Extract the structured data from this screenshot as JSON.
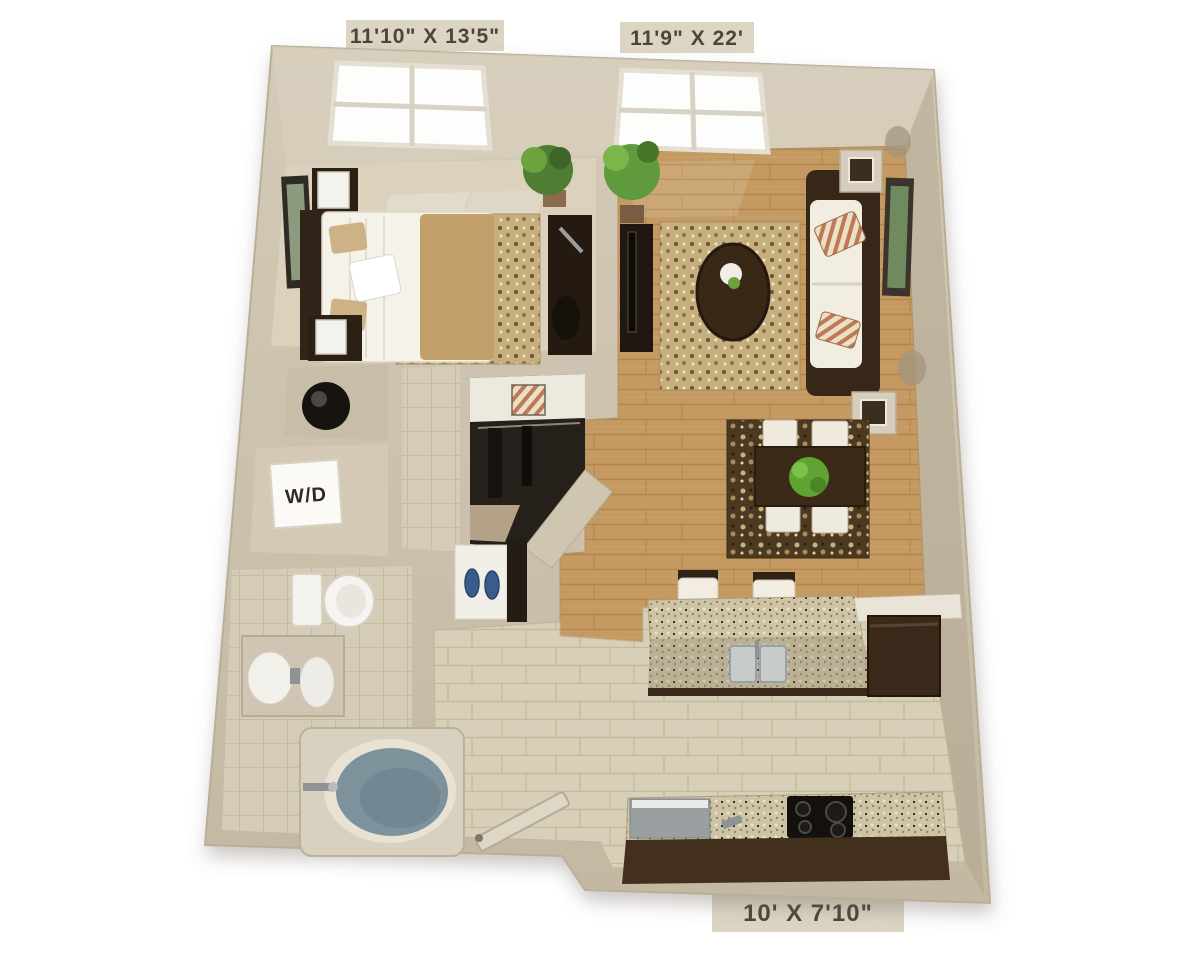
{
  "floor_plan": {
    "view": "3D top-down one-bedroom apartment floor plan",
    "labels": {
      "bedroom_dimensions": "11'10\" X 13'5\"",
      "living_room_dimensions": "11'9\" X 22'",
      "kitchen_dimensions": "10' X 7'10\"",
      "washer_dryer": "W/D"
    },
    "colors": {
      "background": "#ffffff",
      "wall": "#cac0ac",
      "wall_shadow": "#b0a48c",
      "label_tab": "#dcd5c4",
      "label_text": "#4b463b",
      "carpet": "#dbd1bd",
      "wood_floor": "#c49a62",
      "tile_floor": "#d8cfb8",
      "bath_tile": "#d5ccb7",
      "dark_wood": "#3a2a1b",
      "sofa_cushion": "#f2ede1",
      "rug_tan": "#c7ae7d",
      "rug_dark": "#4c3922",
      "granite": "#cfc3a5",
      "bath_water": "#7d929b",
      "plant_green": "#5f9a3e",
      "appliance_gray": "#9aa0a2",
      "closet_dark": "#26201a",
      "slipper_blue": "#3a5c8c"
    }
  }
}
